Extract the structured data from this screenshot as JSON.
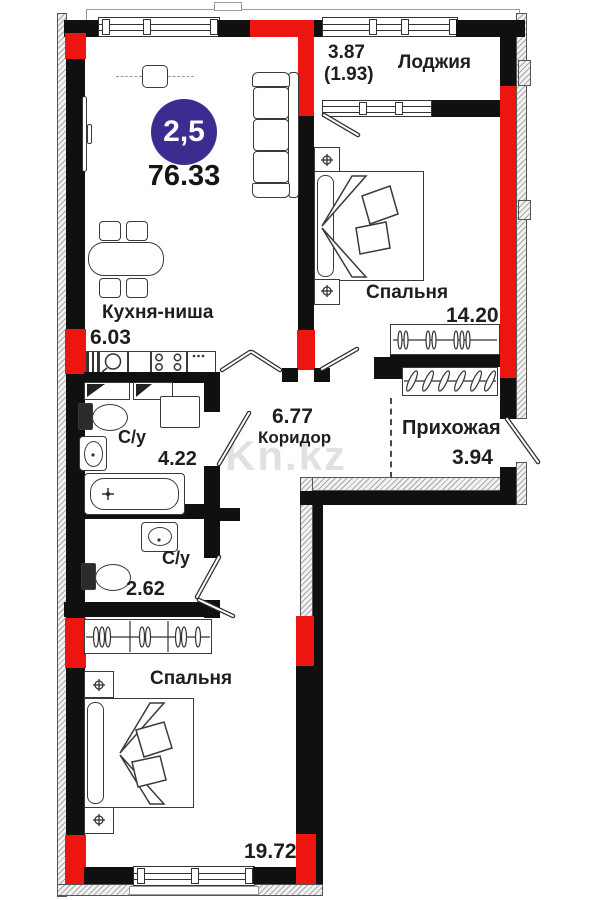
{
  "plan": {
    "badge": {
      "rooms_count": "2,5",
      "total_area": "76.33"
    },
    "watermark": "Kn.kz",
    "colors": {
      "column_red": "#ee1410",
      "badge_indigo": "#3b2d90",
      "wall_black": "#101010"
    },
    "rooms": {
      "loggia": {
        "name": "Лоджия",
        "area": "3.87",
        "area_coeff": "(1.93)"
      },
      "bedroom1": {
        "name": "Спальня",
        "area": "14.20"
      },
      "kitchen": {
        "name": "Кухня-ниша",
        "area": "6.03"
      },
      "corridor": {
        "name": "Коридор",
        "area": "6.77"
      },
      "hallway": {
        "name": "Прихожая",
        "area": "3.94"
      },
      "bath1": {
        "name": "С/у",
        "area": "4.22"
      },
      "bath2": {
        "name": "С/у",
        "area": "2.62"
      },
      "bedroom2": {
        "name": "Спальня",
        "area": "19.72"
      }
    }
  }
}
